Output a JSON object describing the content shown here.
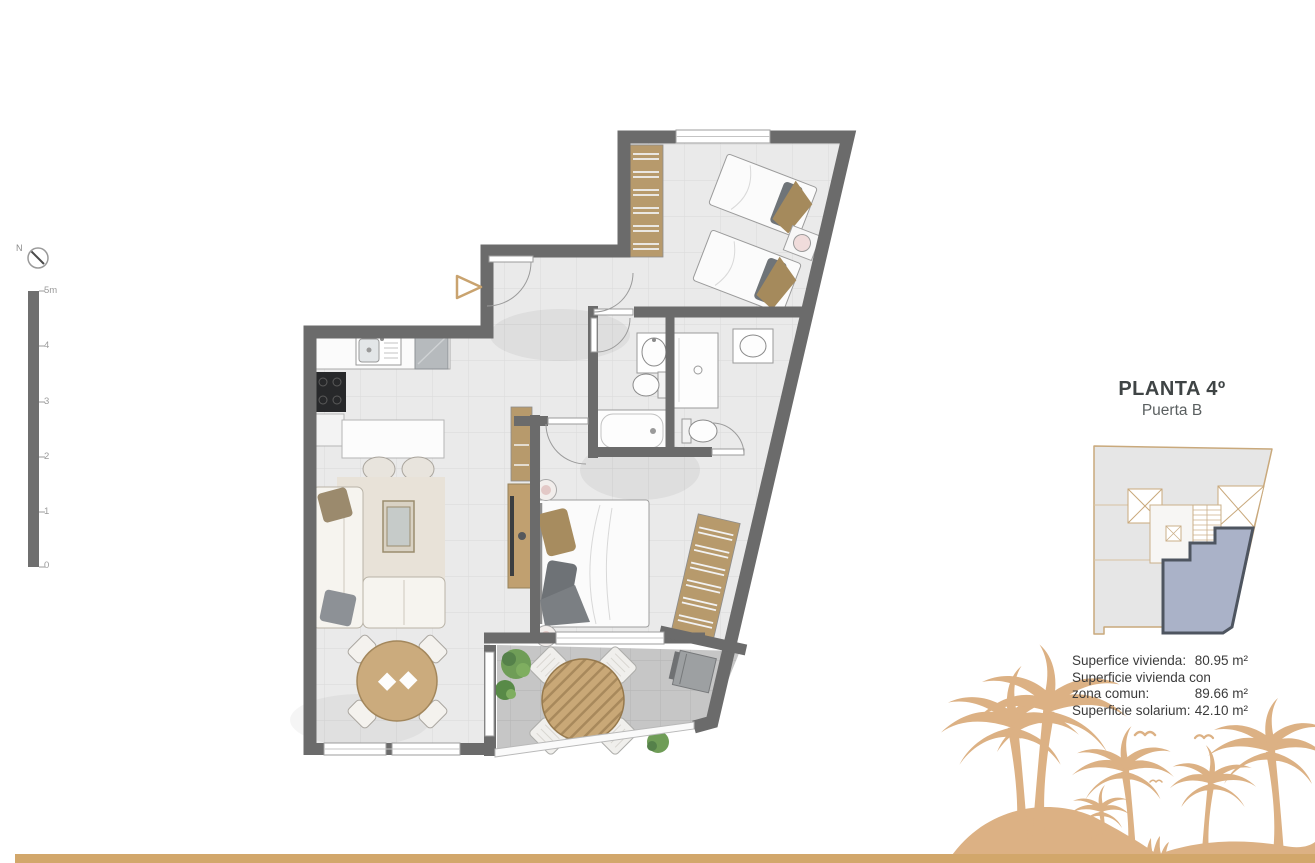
{
  "header": {
    "title": "PLANTA 4º",
    "subtitle": "Puerta B"
  },
  "compass": {
    "label": "N"
  },
  "scale": {
    "labels": [
      "5m",
      "4",
      "3",
      "2",
      "1",
      "0"
    ]
  },
  "areas": {
    "rows": [
      {
        "label": "Superfice vivienda:",
        "value": "80.95 m²"
      },
      {
        "label": "Superficie vivienda con",
        "value": ""
      },
      {
        "label": "zona comun:",
        "value": "89.66 m²"
      },
      {
        "label": "Superficie solarium:",
        "value": "42.10 m²"
      }
    ]
  },
  "colors": {
    "wall": "#6b6b6b",
    "floor": "#eaeaea",
    "terrace_floor": "#c6c6c6",
    "wood": "#c0a070",
    "accent_gold": "#d2a76b",
    "palm": "#dcb184",
    "unit_highlight_fill": "#aab2c8",
    "unit_highlight_border": "#4e5560"
  }
}
